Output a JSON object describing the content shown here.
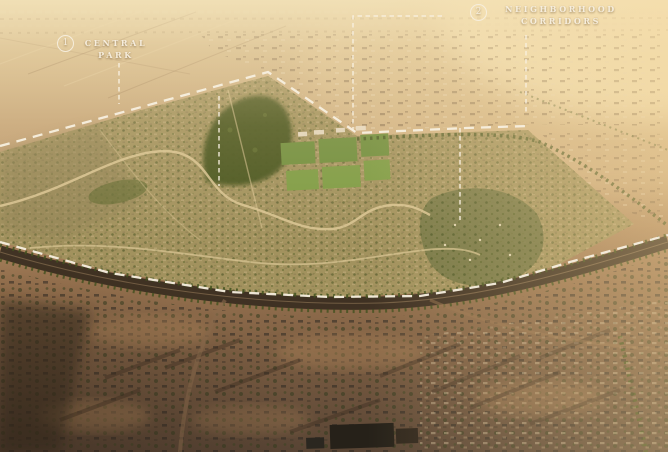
{
  "image": {
    "description": "Golden-hour aerial rendering of a master-planned desert community outlined with a dashed site boundary, annotated with two numbered callouts",
    "regions": {
      "central_park": "dense green park inside the community, upper left of plan",
      "sports_fields": "rectangular green playing fields at plan center",
      "village_center": "tree-filled neighborhood core right of center",
      "existing_fabric": "darker existing low-rise neighborhoods below the main avenue",
      "open_desert": "hazy desert with scattered buildings above and right of the site"
    }
  },
  "annotations": {
    "markers": [
      {
        "number": "1",
        "line1": "CENTRAL",
        "line2": "PARK"
      },
      {
        "number": "2",
        "line1": "NEIGHBORHOOD",
        "line2": "CORRIDORS"
      }
    ]
  },
  "palette": {
    "annotation": "#f7efdf",
    "haze_top": "#e9d6ab",
    "glow": "#f8e9c0",
    "desert_mid": "#bb9a6f",
    "dev_base": "#a2925e",
    "park_green": "#45521e",
    "field_green": "#6f8e3d",
    "village_green": "#707343",
    "tree_green": "#42511f",
    "road_light": "#dcc795",
    "road_dark": "#382d20",
    "ground_dark": "#584434"
  }
}
